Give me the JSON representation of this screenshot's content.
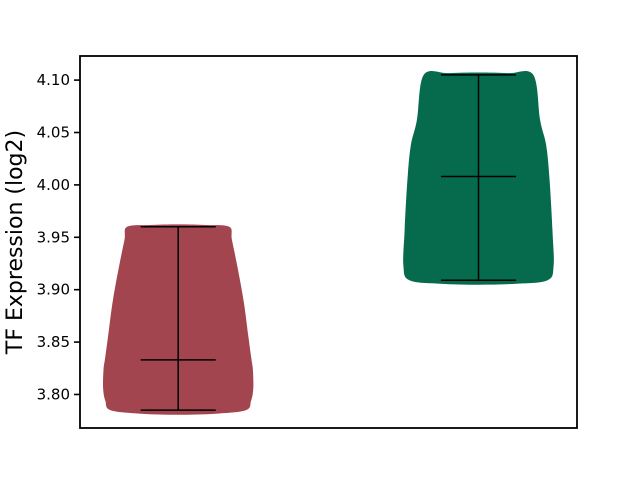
{
  "chart_data": {
    "type": "violin",
    "title": "",
    "xlabel": "",
    "ylabel": "TF Expression (log2)",
    "grid": false,
    "legend": null,
    "yticks": [
      3.8,
      3.85,
      3.9,
      3.95,
      4.0,
      4.05,
      4.1
    ],
    "ytick_labels": [
      "3.80",
      "3.85",
      "3.90",
      "3.95",
      "4.00",
      "4.05",
      "4.10"
    ],
    "xticks": [],
    "ylim": [
      3.768,
      4.123
    ],
    "xlim": [
      0.673,
      2.328
    ],
    "violins": [
      {
        "name": "group-1",
        "position": 1,
        "color": "#a3454f",
        "min": 3.785,
        "median": 3.833,
        "max": 3.96,
        "max_halfwidth": 0.25,
        "cap_halfwidth": 0.125,
        "profile": [
          [
            0.0,
            0.9
          ],
          [
            0.05,
            0.97
          ],
          [
            0.12,
            1.0
          ],
          [
            0.22,
            0.995
          ],
          [
            0.28,
            0.975
          ],
          [
            0.4,
            0.935
          ],
          [
            0.6,
            0.87
          ],
          [
            0.8,
            0.78
          ],
          [
            0.93,
            0.715
          ],
          [
            1.0,
            0.68
          ]
        ]
      },
      {
        "name": "group-2",
        "position": 2,
        "color": "#066b4c",
        "min": 3.909,
        "median": 4.008,
        "max": 4.105,
        "max_halfwidth": 0.25,
        "cap_halfwidth": 0.125,
        "profile": [
          [
            0.0,
            0.92
          ],
          [
            0.07,
            1.0
          ],
          [
            0.24,
            0.985
          ],
          [
            0.5,
            0.945
          ],
          [
            0.66,
            0.9
          ],
          [
            0.78,
            0.82
          ],
          [
            1.0,
            0.73
          ]
        ]
      }
    ]
  }
}
